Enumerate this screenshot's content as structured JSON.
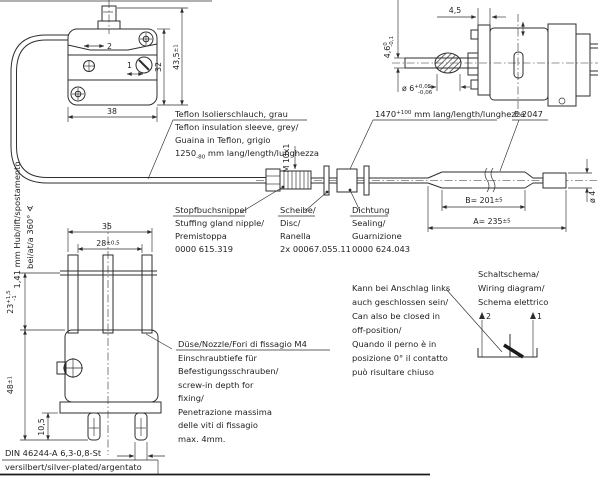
{
  "notes": {
    "teflon": {
      "l1": "Teflon Isolierschlauch, grau",
      "l2": "Teflon insulation sleeve, grey/",
      "l3": "Guaina in Teflon, grigio",
      "l4_value": "1250",
      "l4_tol": "-80",
      "l4_rest": " mm lang/length/lunghezza"
    },
    "gland": {
      "l1": "Stopfbuchsnippel",
      "l2": "Stuffing gland nipple/",
      "l3": "Premistoppa",
      "l4": "0000 615.319"
    },
    "disc": {
      "l1": "Scheibe/",
      "l2": "Disc/",
      "l3": "Ranella",
      "l4": "2x 00067.055.11"
    },
    "seal": {
      "l1": "Dichtung",
      "l2": "Sealing/",
      "l3": "Guarnizione",
      "l4": "0000 624.043"
    },
    "capillary": {
      "value": "1470",
      "tol": "+100",
      "rest": " mm lang/length/lunghezza"
    },
    "probe_code": "F-2047",
    "nozzle": {
      "l1": "Düse/Nozzle/Fori di fissagio M4",
      "l2": "Einschraubtiefe für",
      "l3": "Befestigungsschrauben/",
      "l4": "screw-in depth for",
      "l5": "fixing/",
      "l6": "Penetrazione massima",
      "l7": "delle viti di fissagio",
      "l8": "max. 4mm."
    },
    "off_position": {
      "l1": "Kann bei Anschlag links",
      "l2": "auch geschlossen sein/",
      "l3": "Can also be closed in",
      "l4": "off-position/",
      "l5": "Quando il perno è in",
      "l6": "posizione  0° il contatto",
      "l7": "può risultare chiuso"
    },
    "schematic": {
      "l1": "Schaltschema/",
      "l2": "Wiring diagram/",
      "l3": "Schema elettrico"
    },
    "stroke": {
      "l1": "1,41 mm Hub/lift/spostamento",
      "l2": "bei/at/a 360° ∢"
    },
    "din": {
      "l1": "DIN 46244-A 6,3-0,8-St",
      "l2": "versilbert/silver-plated/argentato"
    }
  },
  "dims": {
    "d435": {
      "main": "43,5",
      "tol": "±1"
    },
    "d32": "32",
    "d38": "38",
    "thread": "M 10x1",
    "dB": {
      "main": "B= 201",
      "tol": "±5"
    },
    "dA": {
      "main": "A= 235",
      "tol": "±5"
    },
    "d45": "4,5",
    "d46": {
      "main": "4,6",
      "tol_top": "0",
      "tol_bottom": "-0,1"
    },
    "d6": {
      "main": "ø 6",
      "tol_top": "+0,05",
      "tol_bottom": "-0,06"
    },
    "d4": "ø 4",
    "d35": "35",
    "d28": {
      "main": "28",
      "tol": "±0,5"
    },
    "d23": {
      "main": "23",
      "tol_top": "+1,5",
      "tol_bottom": "-1"
    },
    "d48": {
      "main": "48",
      "tol": "±1"
    },
    "d105": "10,5"
  },
  "terminals": {
    "switch_2": "2",
    "switch_1": "1",
    "schematic_2": "2",
    "schematic_1": "1"
  },
  "colors": {
    "line": "#2e2e2e",
    "background": "#ffffff"
  }
}
